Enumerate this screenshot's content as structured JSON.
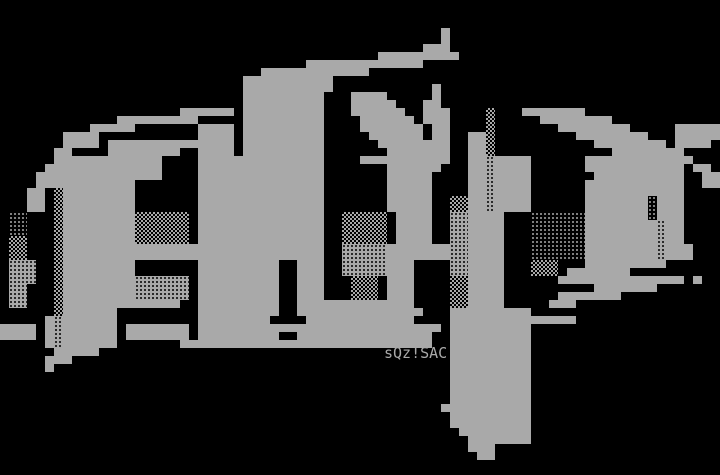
{
  "art": {
    "title": "a5p ANSI logo",
    "letters": "a5p",
    "signature": "sQz!SAC",
    "colors": {
      "background": "#000000",
      "foreground": "#a9a9a9"
    },
    "signature_pos": {
      "x": 384,
      "y": 345
    },
    "grid": {
      "cols": 80,
      "rows": 59,
      "cell_w": 9,
      "cell_h": 8,
      "offset_y": 4,
      "legend": {
        ".": "black",
        "#": "solid-gray",
        "l": "light-dither",
        "m": "medium-dither",
        "d": "dark-dither"
      },
      "rows_rle": [
        "80.",
        "80.",
        "80.",
        "49.1#30.",
        "49.1#30.",
        "47.3#30.",
        "42.9#29.",
        "34.13#33.",
        "29.12#39.",
        "27.10#43.",
        "27.10#11.1#31.",
        "27.9#3.4#5.1#31.",
        "27.9#3.5#3.2#31.",
        "20.6#1.9#3.6#2.3#4.1m3.7#15.",
        "13.9#5.9#4.6#1.3#4.1m5.8#12.",
        "10.5#7.4#1.9#4.7#1.2#4.1m7.8#5.5#",
        "7.4#11.4#1.9#5.6#1.2#2.2#1m9.8#3.5#",
        "7.4#1.14#1.9#6.8#2.2#1m11.8#1.4#1.",
        "6.2#4.8#2.4#1.9#7.7#2.2#1m13.8#4.",
        "6.12#4.14#4.10#2.2#1d4#6.12#3.",
        "5.13#4.14#7.6#3.2#1d4#6.11#1.2#1.",
        "4.14#4.14#7.5#4.2#1d4#7.10#2.2#",
        "4.11#7.14#7.5#4.2#1d4#6.11#2.2#",
        "3.2#1.1m8#7.14#7.5#4.2#1d4#6.11#4.",
        "3.2#1.1m8#7.14#7.5#2.2m2#1d4#6.7#1l3#4.",
        "3.2#1.1m8#7.14#7.5#2.2m2#1d4#6.7#1l3#4.",
        "1.2l3.1m8#6m1.14#2.5m1.4#2.2d4#3.6l7#1l3#4.",
        "1.2l3.1m8#6m1.14#2.5m1.4#2.2d4#3.6l8#1d2#4.",
        "1.2l3.1m8#6m1.14#2.5m1.4#2.2d4#3.6l8#1d2#4.",
        "1.2m3.1m8#6m1.14#2.5m1.4#2.2d4#3.6l8#1d2#4.",
        "1.2m3.1m29#2.5d7#2d4#3.6l8#1d3#3.",
        "1.2m3.1m29#2.5d7#2d4#3.6l8#1d3#3.",
        "1.3d2.1m8#7.9#2.3#2.5d3#4.2d4#3.3m3.9#6.",
        "1.3d2.1m8#7.9#2.3#2.5d3#4.2d4#3.3m1.7#10.",
        "1.3d2.1m8#6d1.9#2.3#3.3m1.3#4.2m4#6.14#1.1#2.",
        "1.2d3.1m8#6d1.9#2.3#3.3m1.3#4.2m4#10.7#7.",
        "1.2d3.1m8#6d1.9#2.3#3.3m1.3#4.2m4#6.7#11.",
        "1.2d3.1m13#2.9#2.13#4.2m4#5.3#16.",
        "6.1m6#9.9#2.14#3.9#21.",
        "5.1#1d6#9.8#4.12#4.14#16.",
        "4#1.1#1d6#1.7#1.27#1.9#21.",
        "4#1.1#1d6#1.7#1.9#2.15#2.9#21.",
        "5.1#1d6#7.28#2.9#21.",
        "6.5#39.9#21.",
        "5.3#42.9#21.",
        "5.1#44.9#21.",
        "50.9#21.",
        "50.9#21.",
        "50.9#21.",
        "50.9#21.",
        "49.10#21.",
        "50.9#21.",
        "50.9#21.",
        "51.8#21.",
        "52.7#21.",
        "52.3#25.",
        "53.2#25.",
        "80.",
        "80."
      ]
    }
  }
}
